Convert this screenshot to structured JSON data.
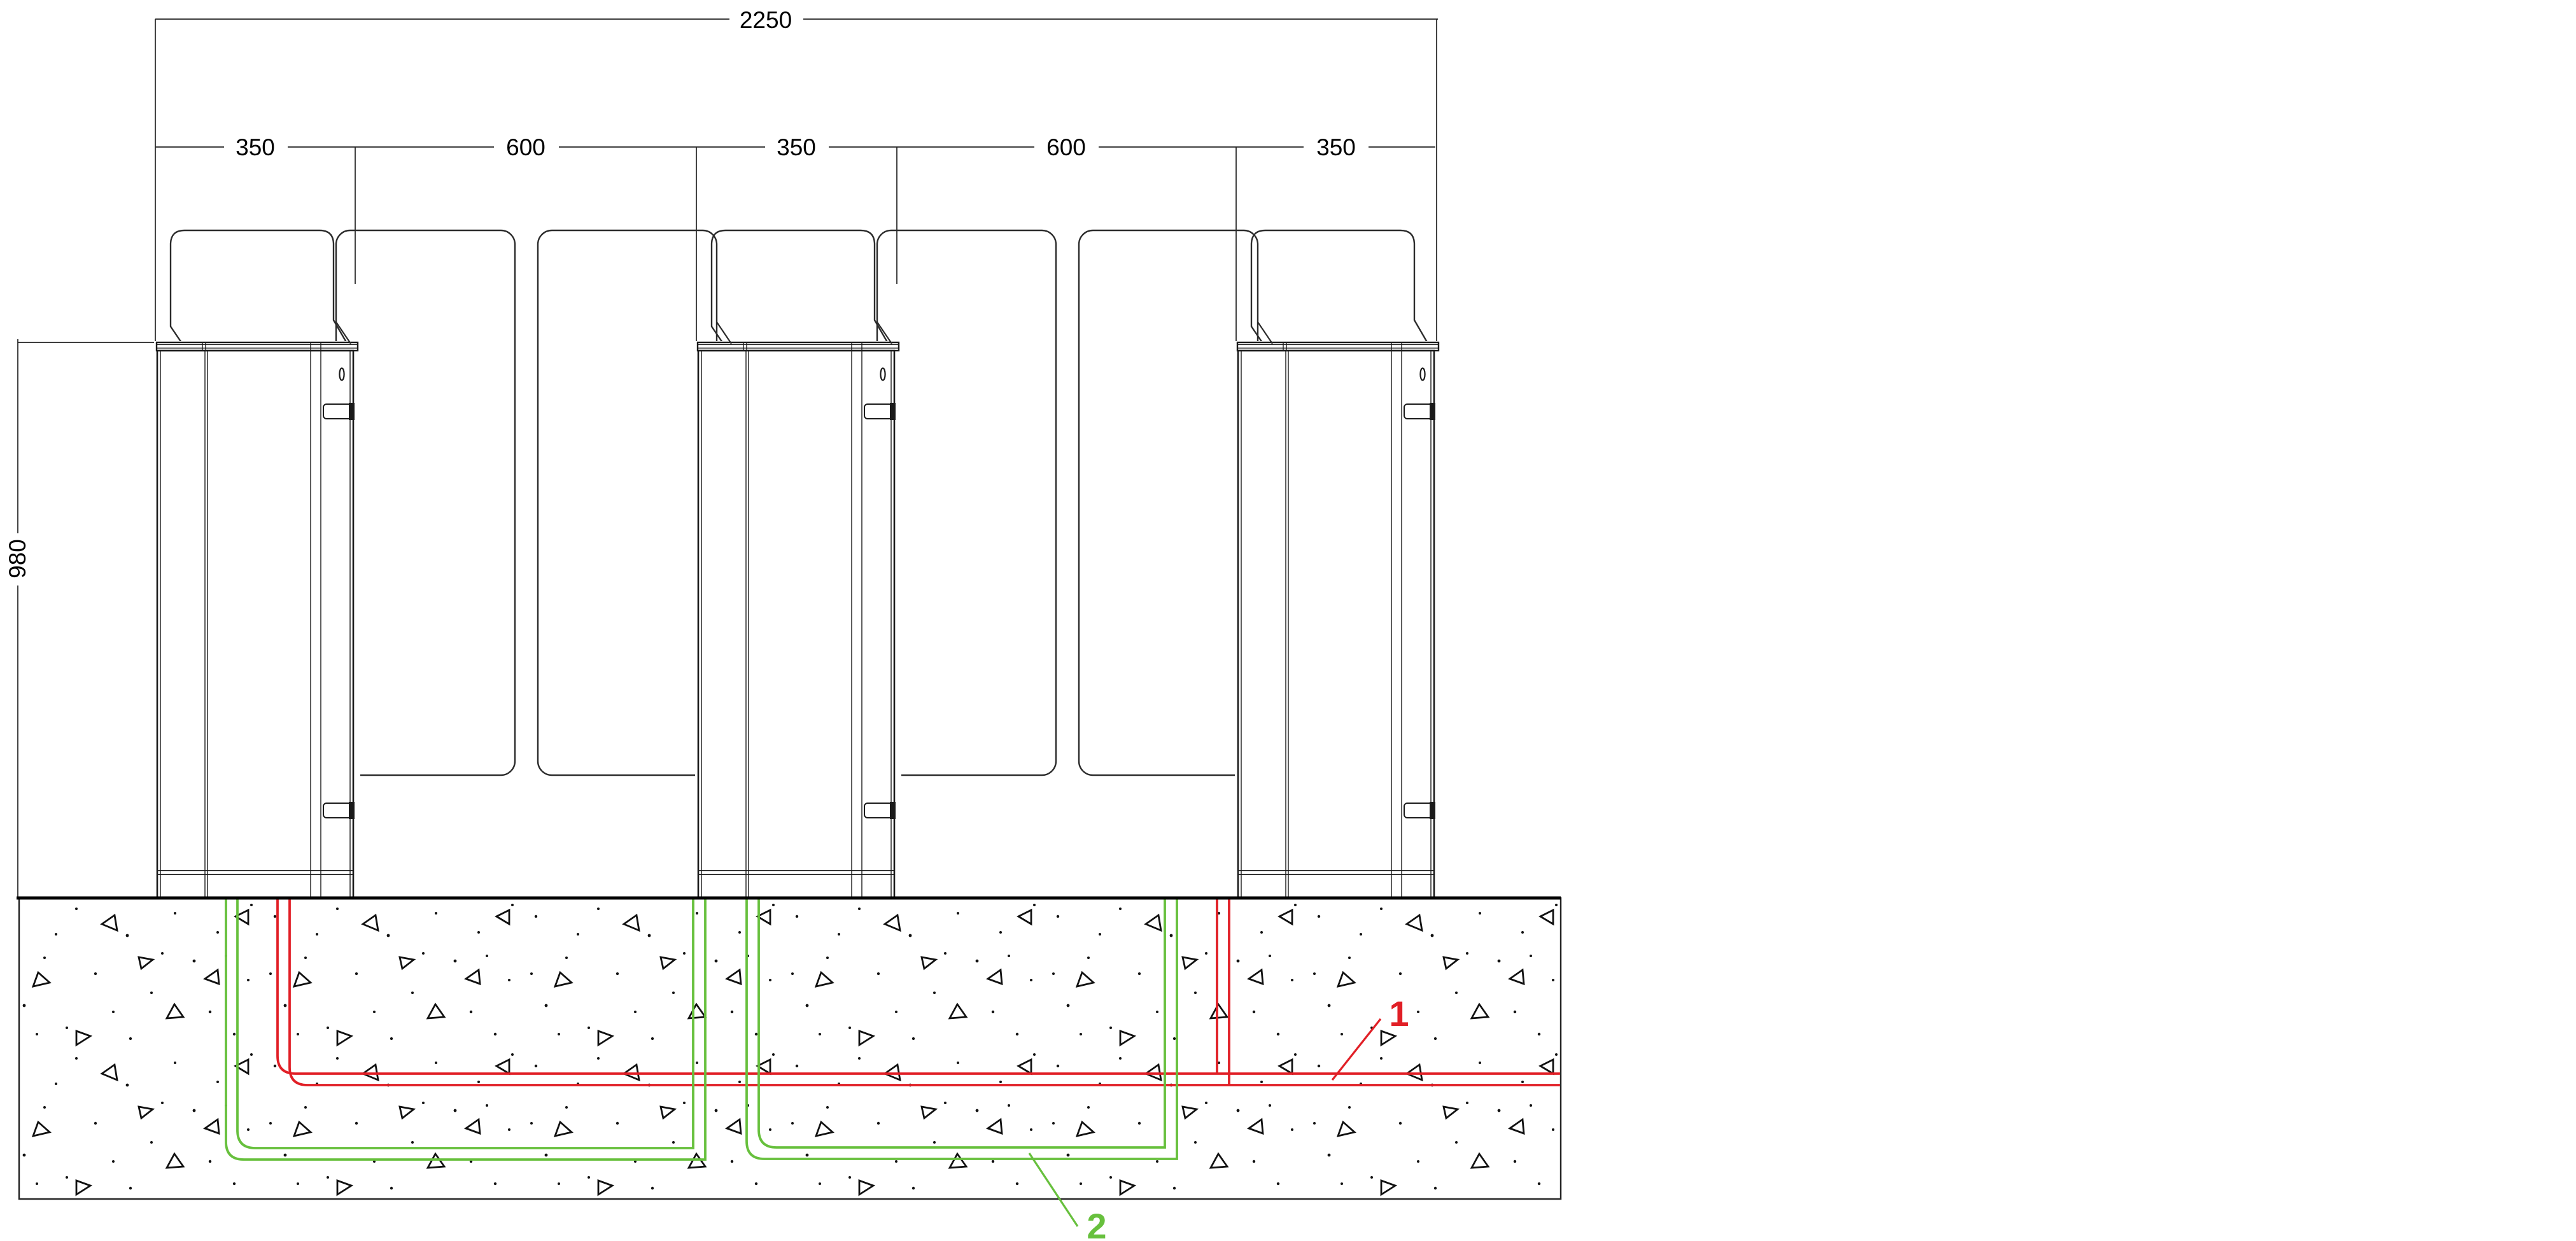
{
  "drawing": {
    "type": "technical-installation-drawing",
    "subject": "turnstile speed gates on concrete foundation with embedded conduits"
  },
  "dimensions": {
    "total_width": "2250",
    "segments": [
      "350",
      "600",
      "350",
      "600",
      "350"
    ],
    "height": "980"
  },
  "callouts": {
    "conduit_1": {
      "number": "1",
      "color": "#e11f26"
    },
    "conduit_2": {
      "number": "2",
      "color": "#67c03d"
    }
  },
  "colors": {
    "ink": "#1a1a1a",
    "dim": "#222222",
    "red_conduit": "#e11f26",
    "green_conduit": "#67c03d"
  }
}
